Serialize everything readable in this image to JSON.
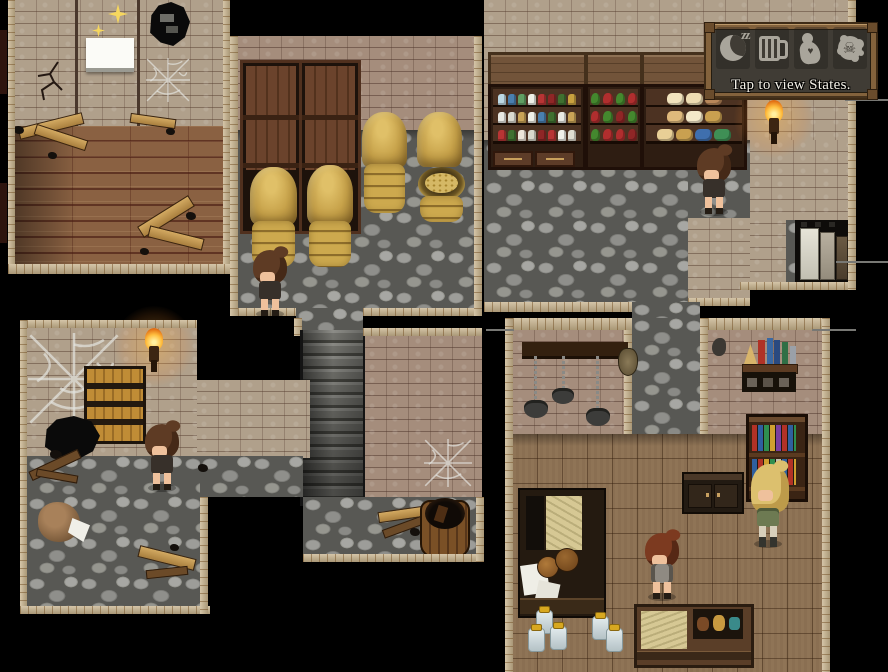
{
  "ui": {
    "states_panel": {
      "label": "Tap to view States.",
      "icons": [
        {
          "name": "sleep-icon",
          "symbol": "crescent-moon",
          "badge": "zz"
        },
        {
          "name": "drink-icon",
          "symbol": "beer-mug"
        },
        {
          "name": "figure-icon",
          "symbol": "kneeling-figure",
          "glyph": "♥"
        },
        {
          "name": "poison-icon",
          "symbol": "skull-splat",
          "glyph": "☠"
        }
      ]
    }
  },
  "palette": {
    "background": "#000000",
    "brick_wall": "#b0a08b",
    "brick_wall_pink": "#a58d7c",
    "cobblestone": "#8e8e8a",
    "wood_plank_floor": "#8a6142",
    "woven_floor": "#8a6f52",
    "border_tile": "#c7b28b",
    "grain_sack": "#c6a149",
    "panel_frame": "#83623c",
    "panel_inner": "#403c35",
    "icon_grey": "#a9a59b",
    "torch_flame": "#ffbf40",
    "sparkle_gold": "#f6d75e"
  },
  "scene": {
    "rooms": [
      {
        "id": "ruined-room"
      },
      {
        "id": "grain-storage"
      },
      {
        "id": "shop"
      },
      {
        "id": "cellar"
      },
      {
        "id": "study"
      }
    ],
    "characters": [
      {
        "id": "villager-storage",
        "hair": "brown"
      },
      {
        "id": "villager-shop",
        "hair": "brown"
      },
      {
        "id": "villager-cellar",
        "hair": "brown"
      },
      {
        "id": "villager-study",
        "hair": "auburn"
      },
      {
        "id": "adventurer-blonde",
        "hair": "blonde"
      }
    ]
  },
  "shop": {
    "shelf1_rows": [
      [
        "#bcd8e4",
        "#4a7fae",
        "#5f9e62",
        "#eef0e8",
        "#b83434",
        "#8f2626",
        "#3f7030",
        "#c9a13f"
      ],
      [
        "#e9e9e3",
        "#d9d9cf",
        "#caa457",
        "#f1f1e9",
        "#4a7fae",
        "#3f7030",
        "#e9e9e3",
        "#caa457"
      ],
      [
        "#b83434",
        "#3f7030",
        "#ece6da",
        "#d8d8cc",
        "#8f2626",
        "#b83434",
        "#f1f1e9",
        "#e0ddd0"
      ]
    ],
    "shelf2_rows": [
      [
        "#44882e",
        "#b02e2e",
        "#44882e",
        "#b02e2e"
      ],
      [
        "#b02e2e",
        "#44882e",
        "#8f2626",
        "#44882e"
      ],
      [
        "#44882e",
        "#b02e2e",
        "#b02e2e",
        "#8f2626"
      ]
    ],
    "shelf3_rows": [
      [
        "#f2e3bd",
        "#eedcb2",
        "#b9875a"
      ],
      [
        "#dfb97c",
        "#f4e8c8",
        "#caa050"
      ],
      [
        "#e8cf96",
        "#c9a050",
        "#3f6fae",
        "#3f8f55"
      ]
    ]
  }
}
